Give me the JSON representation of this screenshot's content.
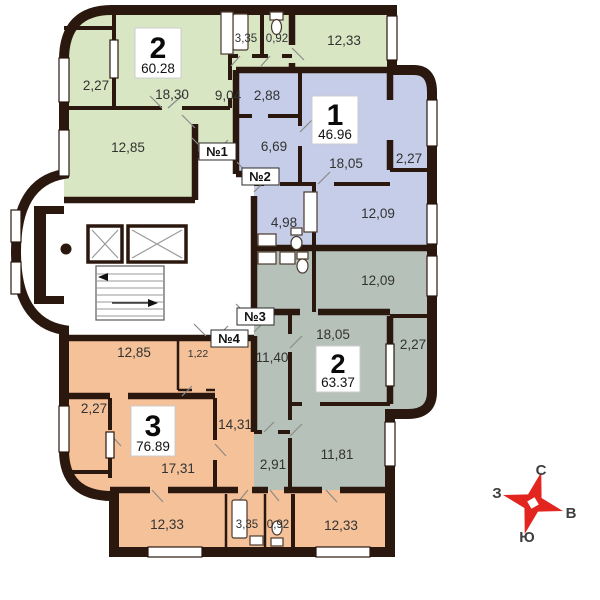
{
  "apartments": [
    {
      "key": "green-two-room",
      "number": "2",
      "area": "60.28",
      "rooms": {
        "balcony": "2,27",
        "living": "18,30",
        "bedroom": "12,85",
        "hall": "9,04",
        "bath": "3,35",
        "wc": "0,92",
        "kitchen": "12,33"
      }
    },
    {
      "key": "blue-one-room",
      "number": "1",
      "area": "46.96",
      "rooms": {
        "entry": "2,88",
        "hall": "6,69",
        "living": "18,05",
        "balcony": "2,27",
        "bath": "4,98",
        "kitchen": "12,09"
      }
    },
    {
      "key": "gray-two-room",
      "number": "2",
      "area": "63.37",
      "rooms": {
        "kitchen": "12,09",
        "living": "18,05",
        "balcony": "2,27",
        "hall": "11,40",
        "bedroom": "11,81",
        "bath": "2,91"
      }
    },
    {
      "key": "orange-three-room",
      "number": "3",
      "area": "76.89",
      "rooms": {
        "bedroom1": "12,85",
        "closet": "1,22",
        "hall": "14,31",
        "living": "17,31",
        "balcony": "2,27",
        "bedroom2": "12,33",
        "bath": "3,35",
        "wc": "0,92",
        "kitchen": "12,33"
      }
    }
  ],
  "entrances": {
    "e1": "№1",
    "e2": "№2",
    "e3": "№3",
    "e4": "№4"
  },
  "compass": {
    "north": "С",
    "east": "В",
    "south": "Ю",
    "west": "З"
  },
  "colors": {
    "apt_green": "#d9e6c3",
    "apt_blue": "#c5cde8",
    "apt_gray": "#b6c1b9",
    "apt_orange": "#f5c198",
    "wall": "#2a170e",
    "compass_red": "#e32520"
  }
}
